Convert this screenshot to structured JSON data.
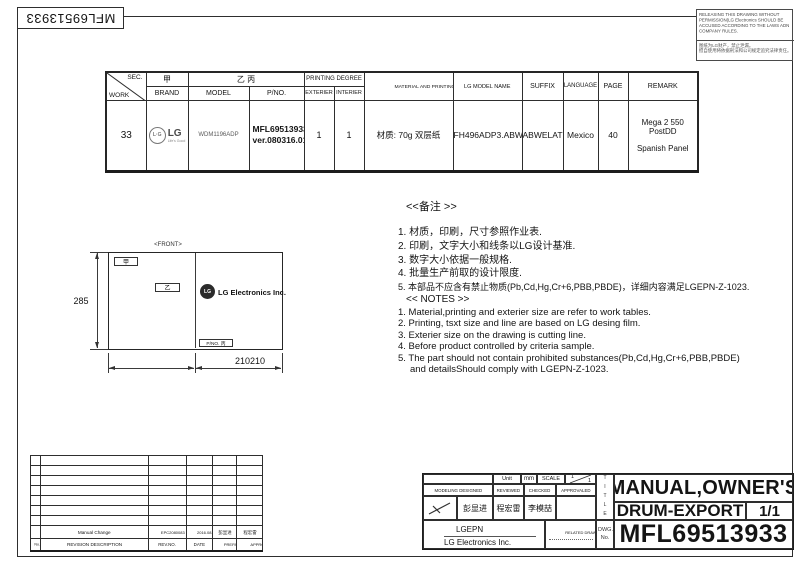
{
  "page": {
    "rotated_doc_no": "MFL69513933",
    "warning": {
      "en": "RELEASING THIS DRAWING WITHOUT PERMISSION(LG Electronics SHOULD BE ACCUSED ACCORDING TO THE LAWS ADN COMPANY RULES.",
      "cn1": "图纸为LG财产，禁止泄漏。",
      "cn2": "擅自使用将依据刑法和公司规定追究法律责任。"
    }
  },
  "work_table": {
    "corner": {
      "top": "SEC.",
      "bottom": "WORK"
    },
    "headers": {
      "brand_cn": "甲",
      "model_pno_cn": "乙 丙",
      "printing_degree": "PRINTING DEGREE",
      "brand": "BRAND",
      "model": "MODEL",
      "pno": "P/NO.",
      "exterier": "EXTERIER",
      "interier": "INTERIER",
      "material": "MATERIAL AND PRINTING DESCRIPTION",
      "lg_model_name": "LG MODEL NAME",
      "suffix": "SUFFIX",
      "language": "LANGUAGE",
      "page": "PAGE",
      "remark": "REMARK"
    },
    "row": {
      "work": "33",
      "brand_logo": "LG",
      "brand_tagline": "Life's Good",
      "model": "WDM1196ADP",
      "pno_line1": "MFL69513933",
      "pno_line2": "ver.080316.01",
      "exterier": "1",
      "interier": "1",
      "material": "材质: 70g 双层纸",
      "lg_model_name": "FH496ADP3.ABWELAT",
      "suffix": "ABWELAT",
      "language": "Mexico",
      "page": "40",
      "remark_line1": "Mega 2 550",
      "remark_line2": "PostDD",
      "remark_line3": "Spanish Panel"
    }
  },
  "notes_cn": {
    "title": "<<备注 >>",
    "items": [
      "1. 材质，印刷，尺寸参照作业表.",
      "2. 印刷，文字大小和线条以LG设计基准.",
      "3. 数字大小依据一般规格.",
      "4. 批量生产前取的设计限度.",
      "5. 本部品不应含有禁止物质(Pb,Cd,Hg,Cr+6,PBB,PBDE)，详细内容满足LGEPN-Z-1023."
    ]
  },
  "notes_en": {
    "title": "<< NOTES >>",
    "items": [
      "1. Material,printing and exterier size are refer to work tables.",
      "2. Printing, tsxt  size and line are based on LG desing film.",
      "3. Exterier size on the drawing is cutting line.",
      "4. Before product controlled by criteria sample.",
      "5. The part should not contain prohibited substances(Pb,Cd,Hg,Cr+6,PBB,PBDE)",
      "and detailsShould comply with LGEPN-Z-1023."
    ]
  },
  "drawing": {
    "front_label": "<FRONT>",
    "tag_a": "甲",
    "tag_b": "乙",
    "logo_text": "LG",
    "company": "LG Electronics Inc.",
    "pno_tag": "P/NO. 丙",
    "dim_height": "285",
    "dim_width": "210210"
  },
  "revision_table": {
    "headers": {
      "no": "No.",
      "description": "REVISION DESCRIPTION",
      "rev_no": "REV.NO.",
      "date": "DATE",
      "prepared": "PREPARED",
      "approvaled": "APPROVALED"
    },
    "entry": {
      "description": "Manual Change",
      "rev_no": "EPC2080083",
      "date": "2016.08.08",
      "prepared": "彭显进",
      "approvaled": "程宏雷"
    }
  },
  "title_block": {
    "unit_label": "Unit",
    "unit_value": "mm",
    "scale_label": "SCALE",
    "scale_num": "1",
    "scale_den": "1",
    "h_modeling_designed": "MODELING DESIGNED",
    "h_reviewed": "REVIEWED",
    "h_checked": "CHECKED",
    "h_approvaled": "APPROVALED",
    "designed_name": "彭显进",
    "reviewed_name": "程宏雷",
    "checked_name": "李模喆",
    "company_short": "LGEPN",
    "company_full": "LG Electronics Inc.",
    "related_drawing": "RELATED DRAWING",
    "title_vertical": "TITLE",
    "dwg_no_label": "DWG. No.",
    "title_line1": "MANUAL,OWNER'S",
    "title_line2": "DRUM-EXPORT",
    "sheet": "1/1",
    "dwg_no": "MFL69513933"
  }
}
